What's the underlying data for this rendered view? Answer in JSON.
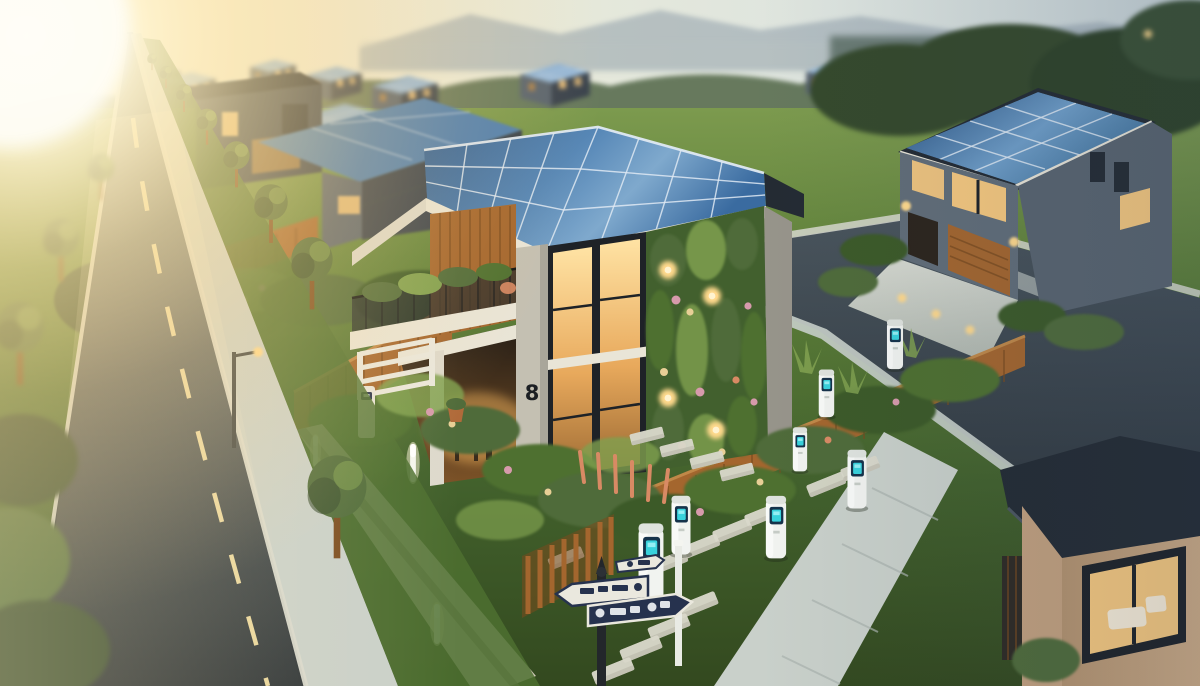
{
  "scene": {
    "description": "Golden-hour 3D rendering of an eco-friendly suburban street: a modern two-storey house with a rooftop solar array and a living green wall, a lush front garden lined with EV charging bollards, a tree-lined asphalt road receding into bright sun glare, and rows of identical solar-roofed houses fading into hazy hills.",
    "time_of_day": "golden hour",
    "sky": {
      "mountains": "hazy mountain ridge",
      "treeline": "distant tree canopy",
      "sun": "bright sun glare upper left"
    },
    "road": {
      "surface": "dark asphalt",
      "center_line": "dashed cream line",
      "direction": "recedes to vanishing point upper left"
    },
    "main_house": {
      "label": "modern eco house",
      "house_number": "8",
      "roof": "large photovoltaic solar array",
      "facade": [
        "floor-to-ceiling lit windows",
        "vertical garden living wall with flowers and sconce lights",
        "timber slat panel",
        "balcony with mesh railing and planters",
        "covered porch with table and chairs"
      ]
    },
    "right_house": {
      "label": "grey two-storey house",
      "roof": "full solar panel roof",
      "features": [
        "lit picture windows",
        "timber garage door",
        "concrete driveway",
        "clipped hedges",
        "path lights"
      ]
    },
    "background_houses": {
      "label": "rows of identical solar-roofed houses",
      "count_visible": 12
    },
    "front_garden": {
      "label": "lush pollinator garden",
      "features": [
        "timber slat fence",
        "white trellis gate",
        "white pedestal post",
        "terracotta pots",
        "stepping-stone paths",
        "glowing bollard lights",
        "low concrete wall",
        "timber picket fence"
      ]
    },
    "ev_chargers": {
      "label": "EV charging bollards",
      "count": 7,
      "screen": "glowing teal display"
    },
    "signpost": {
      "label": "black signpost with arrow signs",
      "plates": [
        {
          "style": "white plate, navy border, pointing left"
        },
        {
          "style": "navy plate, white glyphs, pointing right"
        },
        {
          "style": "small white tag plate"
        }
      ]
    },
    "street_furniture": {
      "lamp": "street lamp on left verge",
      "white_pole": "white lamp pole beside chargers"
    },
    "far_right_building": {
      "label": "tan flat-roof house corner",
      "feature": "large lit window with white sofa"
    },
    "palette": {
      "sky_warm": "#f6eed6",
      "sky_cool": "#ccd7d9",
      "sun_core": "#fffdf4",
      "sun_halo": "#ffd98e",
      "mountain": "#8a99a6",
      "haze": "#b9c3c2",
      "treeline": "#5a6e50",
      "tree_dark": "#35492c",
      "tree_mid": "#4f6b3a",
      "leaf_light": "#7fa04f",
      "grass_lit": "#6e9140",
      "grass_mid": "#4e7030",
      "grass_dark": "#3c5a28",
      "road_dark": "#2b3237",
      "road_mid": "#4e585b",
      "road_marking": "#e8d59b",
      "curb": "#d8d9cf",
      "sidewalk": "#c9d0ca",
      "sidewalk_shade": "#aab3ae",
      "wall_concrete": "#c4c0b2",
      "wall_shade": "#97948a",
      "fascia": "#e9e5d7",
      "wood": "#a4662e",
      "wood_dark": "#7a4a1e",
      "wood_lit": "#c08848",
      "solar_deep": "#2c5a8f",
      "solar_mid": "#4f7fb0",
      "solar_lite": "#8fb3d6",
      "panel_grid": "#dfe9f3",
      "dark_wall": "#39424d",
      "dark_wall_lit": "#59646f",
      "roof_dark": "#242b33",
      "window_warm": "#f6c87e",
      "window_deep": "#c08a45",
      "frame_dark": "#1e2227",
      "living_wall": "#42602e",
      "flower_pink": "#d79aac",
      "flower_peach": "#d88a64",
      "flower_cream": "#e8cf96",
      "charger_body": "#f1f3f0",
      "charger_screen": "#3adbe4",
      "charger_navy": "#15324a",
      "sign_navy": "#26324e",
      "sign_white": "#eae8de",
      "tan_wall": "#c2a07e",
      "tan_wall_lit": "#d4b28c",
      "lamp_warm": "#ffd98c",
      "glow_warm": "#ffbe62"
    }
  }
}
